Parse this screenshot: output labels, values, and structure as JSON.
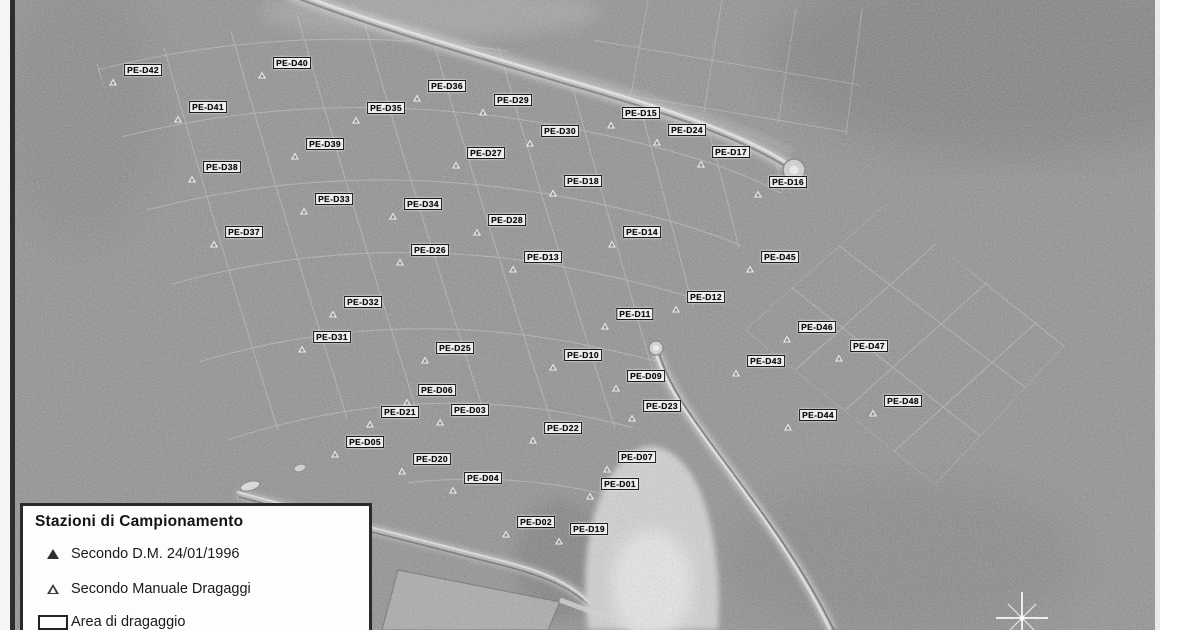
{
  "map": {
    "description": "scanned grayscale aerial photo of harbour with dredging sampling stations",
    "legend": {
      "title": "Stazioni di Campionamento",
      "items": [
        {
          "symbol": "filled-triangle",
          "label": "Secondo D.M. 24/01/1996"
        },
        {
          "symbol": "open-triangle",
          "label": "Secondo Manuale Dragaggi"
        },
        {
          "symbol": "rectangle",
          "label": "Area di dragaggio"
        }
      ]
    },
    "stations": [
      {
        "id": "PE-D42",
        "x": 143,
        "y": 70
      },
      {
        "id": "PE-D40",
        "x": 292,
        "y": 63
      },
      {
        "id": "PE-D41",
        "x": 208,
        "y": 107
      },
      {
        "id": "PE-D36",
        "x": 447,
        "y": 86
      },
      {
        "id": "PE-D35",
        "x": 386,
        "y": 108
      },
      {
        "id": "PE-D29",
        "x": 513,
        "y": 100
      },
      {
        "id": "PE-D15",
        "x": 641,
        "y": 113
      },
      {
        "id": "PE-D24",
        "x": 687,
        "y": 130
      },
      {
        "id": "PE-D30",
        "x": 560,
        "y": 131
      },
      {
        "id": "PE-D17",
        "x": 731,
        "y": 152
      },
      {
        "id": "PE-D39",
        "x": 325,
        "y": 144
      },
      {
        "id": "PE-D27",
        "x": 486,
        "y": 153
      },
      {
        "id": "PE-D38",
        "x": 222,
        "y": 167
      },
      {
        "id": "PE-D18",
        "x": 583,
        "y": 181
      },
      {
        "id": "PE-D16",
        "x": 788,
        "y": 182
      },
      {
        "id": "PE-D33",
        "x": 334,
        "y": 199
      },
      {
        "id": "PE-D34",
        "x": 423,
        "y": 204
      },
      {
        "id": "PE-D28",
        "x": 507,
        "y": 220
      },
      {
        "id": "PE-D37",
        "x": 244,
        "y": 232
      },
      {
        "id": "PE-D14",
        "x": 642,
        "y": 232
      },
      {
        "id": "PE-D26",
        "x": 430,
        "y": 250
      },
      {
        "id": "PE-D13",
        "x": 543,
        "y": 257
      },
      {
        "id": "PE-D45",
        "x": 780,
        "y": 257
      },
      {
        "id": "PE-D32",
        "x": 363,
        "y": 302
      },
      {
        "id": "PE-D12",
        "x": 706,
        "y": 297
      },
      {
        "id": "PE-D11",
        "x": 635,
        "y": 314
      },
      {
        "id": "PE-D31",
        "x": 332,
        "y": 337
      },
      {
        "id": "PE-D46",
        "x": 817,
        "y": 327
      },
      {
        "id": "PE-D47",
        "x": 869,
        "y": 346
      },
      {
        "id": "PE-D25",
        "x": 455,
        "y": 348
      },
      {
        "id": "PE-D10",
        "x": 583,
        "y": 355
      },
      {
        "id": "PE-D43",
        "x": 766,
        "y": 361
      },
      {
        "id": "PE-D09",
        "x": 646,
        "y": 376
      },
      {
        "id": "PE-D06",
        "x": 437,
        "y": 390
      },
      {
        "id": "PE-D21",
        "x": 400,
        "y": 412
      },
      {
        "id": "PE-D03",
        "x": 470,
        "y": 410
      },
      {
        "id": "PE-D23",
        "x": 662,
        "y": 406
      },
      {
        "id": "PE-D48",
        "x": 903,
        "y": 401
      },
      {
        "id": "PE-D44",
        "x": 818,
        "y": 415
      },
      {
        "id": "PE-D22",
        "x": 563,
        "y": 428
      },
      {
        "id": "PE-D05",
        "x": 365,
        "y": 442
      },
      {
        "id": "PE-D20",
        "x": 432,
        "y": 459
      },
      {
        "id": "PE-D07",
        "x": 637,
        "y": 457
      },
      {
        "id": "PE-D04",
        "x": 483,
        "y": 478
      },
      {
        "id": "PE-D01",
        "x": 620,
        "y": 484
      },
      {
        "id": "PE-D02",
        "x": 536,
        "y": 522
      },
      {
        "id": "PE-D19",
        "x": 589,
        "y": 529
      }
    ],
    "compass": {
      "x": 1022,
      "y": 618
    },
    "colors": {
      "water_gray": "#8f8f8f",
      "label_bg": "#efefef",
      "label_border": "#1c1c1c",
      "label_text": "#0d0d0d",
      "legend_bg": "#fdfdfd",
      "legend_border": "#2a2a2a"
    }
  }
}
